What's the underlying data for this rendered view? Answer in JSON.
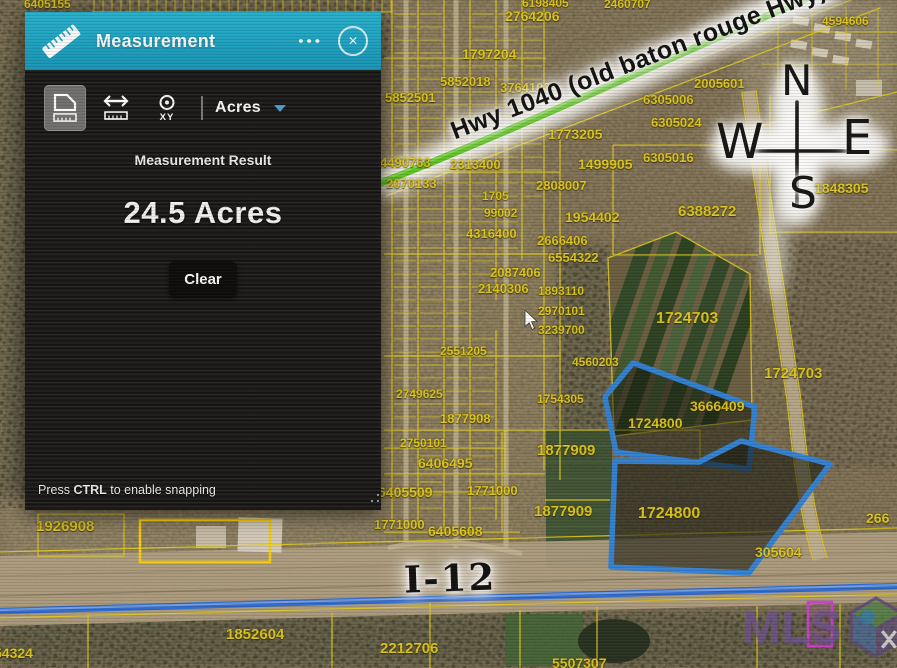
{
  "panel": {
    "title": "Measurement",
    "menu_dots": "•••",
    "close_glyph": "✕",
    "toolbar": {
      "unit_value": "Acres",
      "xy_label": "XY"
    },
    "result_label": "Measurement Result",
    "result_value": "24.5 Acres",
    "clear_label": "Clear",
    "hint": {
      "prefix": "Press ",
      "key": "CTRL",
      "suffix": " to enable snapping"
    }
  },
  "map": {
    "annotations": {
      "highway": "Hwy 1040 (old baton rouge Hwy)",
      "interstate": "I-12",
      "watermark": "MLS",
      "compass": {
        "n": "N",
        "e": "E",
        "s": "S",
        "w": "W"
      }
    },
    "parcel_labels": [
      {
        "text": "6405155",
        "x": 24,
        "y": -3,
        "size": 12
      },
      {
        "text": "6198405",
        "x": 522,
        "y": -4,
        "size": 12
      },
      {
        "text": "2460707",
        "x": 604,
        "y": -3,
        "size": 12
      },
      {
        "text": "2764206",
        "x": 505,
        "y": 8,
        "size": 14
      },
      {
        "text": "4594606",
        "x": 822,
        "y": 14,
        "size": 12
      },
      {
        "text": "1797204",
        "x": 462,
        "y": 46,
        "size": 14
      },
      {
        "text": "5852018",
        "x": 440,
        "y": 74,
        "size": 13
      },
      {
        "text": "5852501",
        "x": 385,
        "y": 90,
        "size": 13
      },
      {
        "text": "3764103",
        "x": 500,
        "y": 80,
        "size": 13
      },
      {
        "text": "6305006",
        "x": 643,
        "y": 92,
        "size": 13
      },
      {
        "text": "2005601",
        "x": 694,
        "y": 76,
        "size": 13
      },
      {
        "text": "6305024",
        "x": 651,
        "y": 115,
        "size": 13
      },
      {
        "text": "1773205",
        "x": 548,
        "y": 126,
        "size": 14
      },
      {
        "text": "6305016",
        "x": 643,
        "y": 150,
        "size": 13
      },
      {
        "text": "4490763",
        "x": 380,
        "y": 155,
        "size": 13
      },
      {
        "text": "2313400",
        "x": 450,
        "y": 157,
        "size": 13
      },
      {
        "text": "1499905",
        "x": 578,
        "y": 156,
        "size": 14
      },
      {
        "text": "2070133",
        "x": 386,
        "y": 176,
        "size": 13
      },
      {
        "text": "1705",
        "x": 482,
        "y": 189,
        "size": 12
      },
      {
        "text": "2808007",
        "x": 536,
        "y": 178,
        "size": 13
      },
      {
        "text": "1848305",
        "x": 814,
        "y": 180,
        "size": 14
      },
      {
        "text": "99002",
        "x": 484,
        "y": 206,
        "size": 12
      },
      {
        "text": "6388272",
        "x": 678,
        "y": 203,
        "size": 15
      },
      {
        "text": "1954402",
        "x": 565,
        "y": 209,
        "size": 14
      },
      {
        "text": "4316400",
        "x": 466,
        "y": 226,
        "size": 13
      },
      {
        "text": "2666406",
        "x": 537,
        "y": 233,
        "size": 13
      },
      {
        "text": "6554322",
        "x": 548,
        "y": 250,
        "size": 13
      },
      {
        "text": "2087406",
        "x": 490,
        "y": 265,
        "size": 13
      },
      {
        "text": "2140306",
        "x": 478,
        "y": 281,
        "size": 13
      },
      {
        "text": "1893110",
        "x": 538,
        "y": 284,
        "size": 12
      },
      {
        "text": "2970101",
        "x": 538,
        "y": 304,
        "size": 12
      },
      {
        "text": "1724703",
        "x": 656,
        "y": 310,
        "size": 16
      },
      {
        "text": "3239700",
        "x": 538,
        "y": 323,
        "size": 12
      },
      {
        "text": "2551205",
        "x": 440,
        "y": 344,
        "size": 12
      },
      {
        "text": "4560203",
        "x": 572,
        "y": 355,
        "size": 12
      },
      {
        "text": "1724703",
        "x": 764,
        "y": 365,
        "size": 15
      },
      {
        "text": "2749625",
        "x": 396,
        "y": 387,
        "size": 12
      },
      {
        "text": "1754305",
        "x": 537,
        "y": 392,
        "size": 12
      },
      {
        "text": "3666409",
        "x": 690,
        "y": 398,
        "size": 14
      },
      {
        "text": "1877908",
        "x": 440,
        "y": 411,
        "size": 13
      },
      {
        "text": "1724800",
        "x": 628,
        "y": 415,
        "size": 14
      },
      {
        "text": "2750101",
        "x": 400,
        "y": 436,
        "size": 12
      },
      {
        "text": "1877909",
        "x": 537,
        "y": 442,
        "size": 15
      },
      {
        "text": "6406495",
        "x": 418,
        "y": 455,
        "size": 14
      },
      {
        "text": "6405509",
        "x": 378,
        "y": 484,
        "size": 14
      },
      {
        "text": "1771000",
        "x": 467,
        "y": 483,
        "size": 13
      },
      {
        "text": "1877909",
        "x": 534,
        "y": 503,
        "size": 15
      },
      {
        "text": "1724800",
        "x": 638,
        "y": 505,
        "size": 16
      },
      {
        "text": "266",
        "x": 866,
        "y": 510,
        "size": 14
      },
      {
        "text": "1771000",
        "x": 374,
        "y": 517,
        "size": 13
      },
      {
        "text": "6405608",
        "x": 428,
        "y": 523,
        "size": 14
      },
      {
        "text": "1926908",
        "x": 36,
        "y": 518,
        "size": 15
      },
      {
        "text": "305604",
        "x": 755,
        "y": 544,
        "size": 14
      },
      {
        "text": "1852604",
        "x": 226,
        "y": 626,
        "size": 15
      },
      {
        "text": "2212706",
        "x": 380,
        "y": 640,
        "size": 15
      },
      {
        "text": "54324",
        "x": -6,
        "y": 645,
        "size": 14
      },
      {
        "text": "5507307",
        "x": 552,
        "y": 655,
        "size": 14
      }
    ]
  },
  "colors": {
    "header_teal": "#1aa8c8",
    "parcel_yellow": "#e3cf1f",
    "selection_blue": "#2f84dc",
    "highway_green": "#5ec622",
    "interstate_blue": "#2e6cd2",
    "watermark_purple": "#6b4f8f"
  }
}
